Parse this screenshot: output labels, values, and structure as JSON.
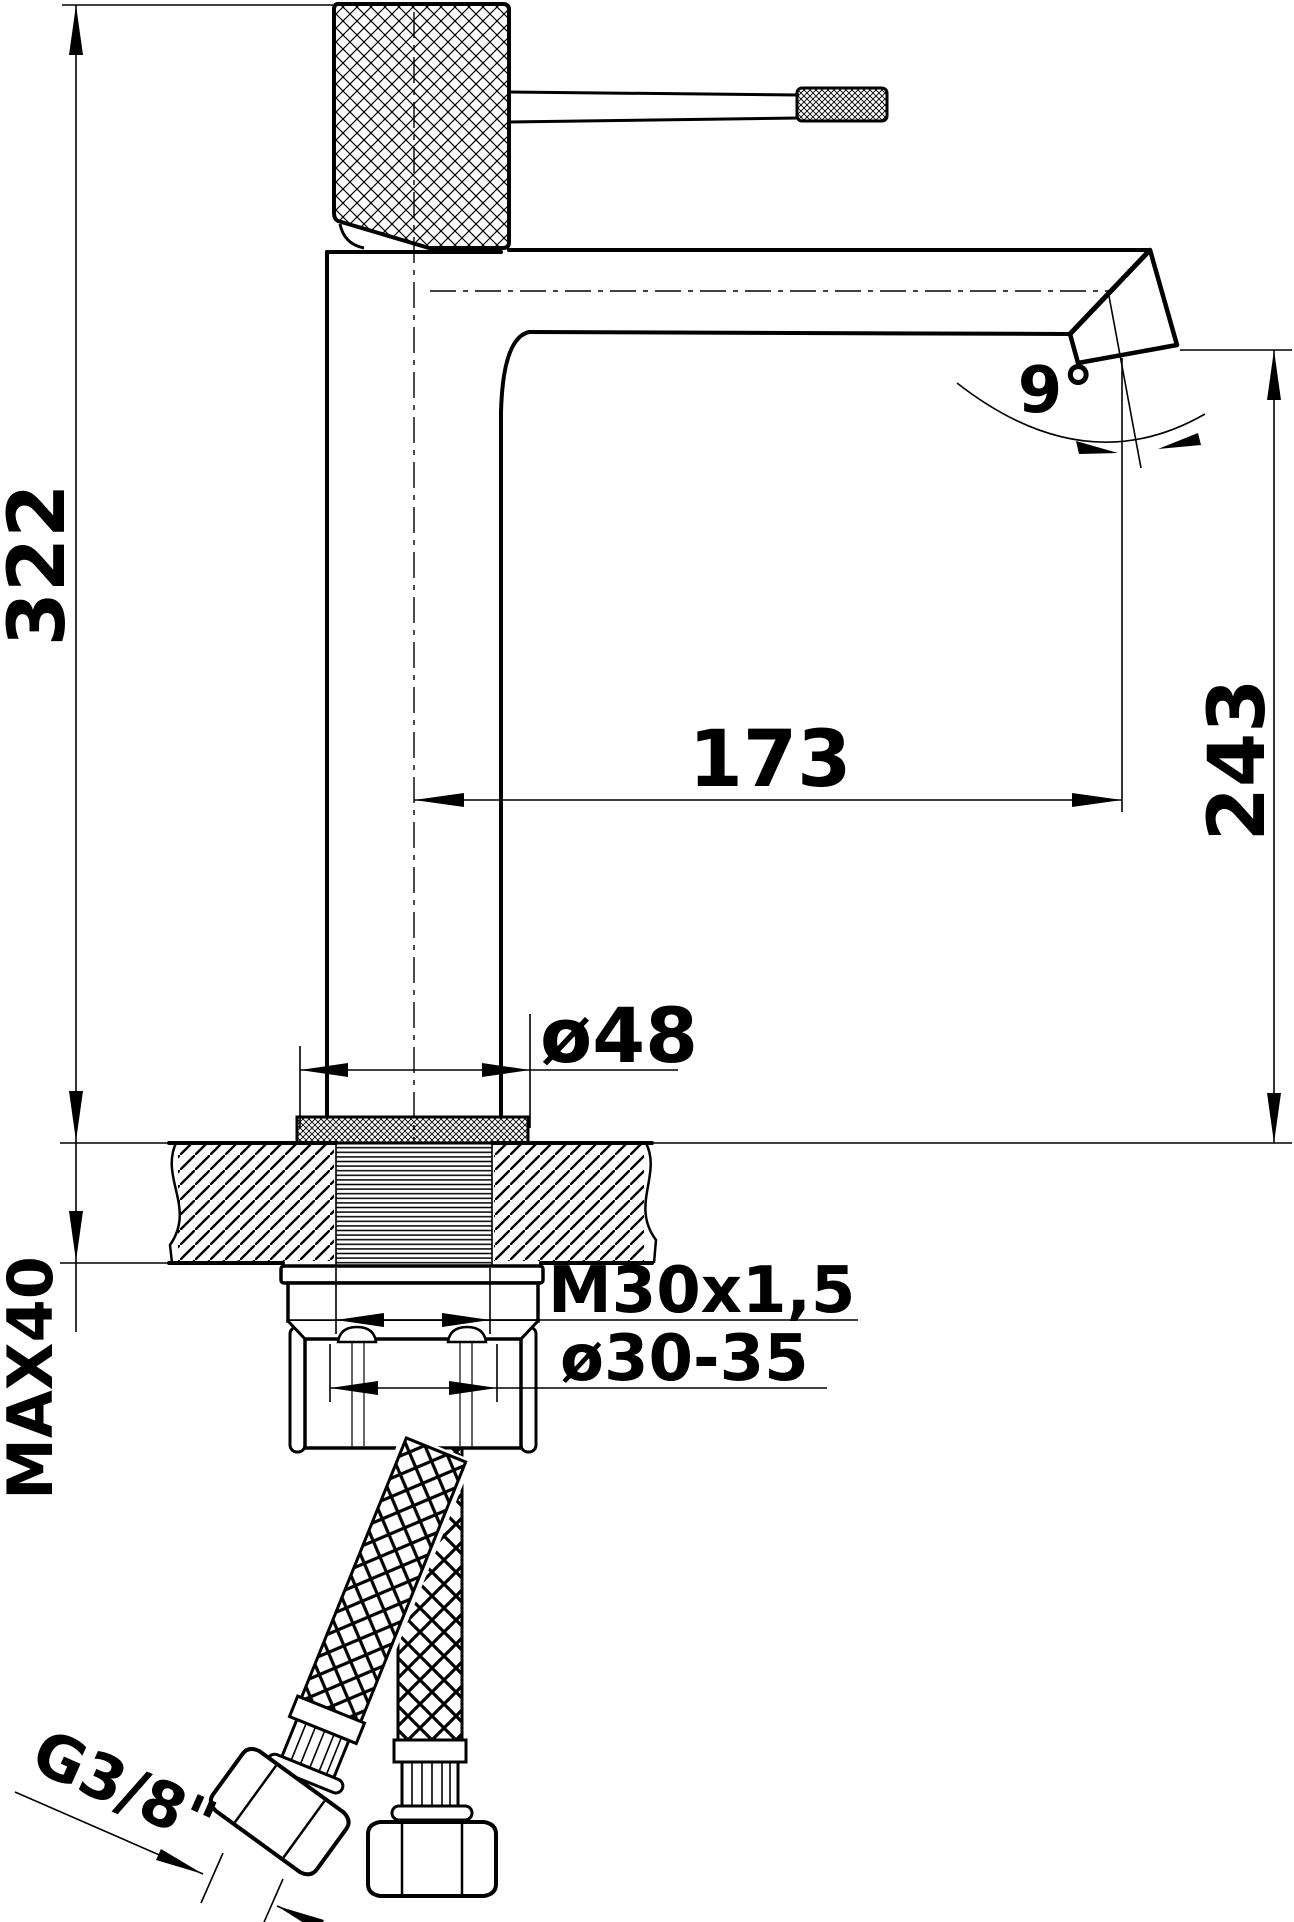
{
  "drawing": {
    "title": "faucet-technical-drawing",
    "type": "dimensioned side-view technical drawing of a tall single-lever basin mixer faucet",
    "colors": {
      "line": "#000000",
      "background": "#ffffff"
    },
    "labels": {
      "total_height": "322",
      "spout_reach": "173",
      "spout_outlet_height": "243",
      "spout_angle": "9°",
      "base_diameter": "ø48",
      "max_counter_thickness": "MAX40",
      "mounting_thread": "M30x1,5",
      "hole_diameter": "ø30-35",
      "hose_connection": "G3/8\""
    }
  }
}
